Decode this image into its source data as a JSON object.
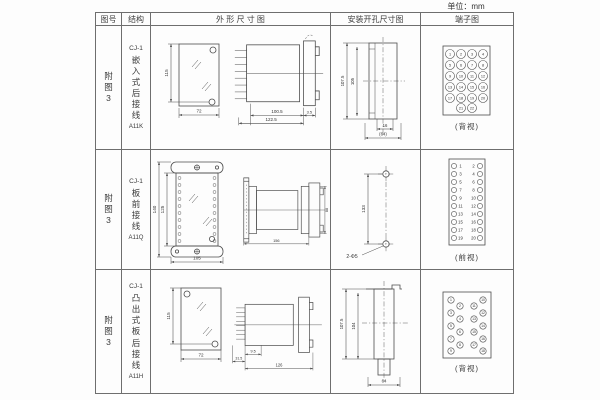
{
  "unit": "单位：mm",
  "header": {
    "fig": "图号",
    "structure": "结构",
    "outline": "外 形 尺 寸 图",
    "mounting": "安装开孔尺寸图",
    "terminal": "端子图"
  },
  "rows": [
    {
      "fig": "附图3",
      "model": "CJ-1",
      "struct": "嵌入式后接线",
      "code": "A11K",
      "view": "(背视)",
      "fd": [
        {
          "x1": 20,
          "y1": 12,
          "x2": 20,
          "y2": 70,
          "t": "115",
          "r": 1,
          "o": 3
        },
        {
          "x1": 28,
          "y1": 83,
          "x2": 68,
          "y2": 83,
          "t": "72"
        }
      ],
      "sd": [
        {
          "x1": 24,
          "y1": 84,
          "x2": 78,
          "y2": 84,
          "t": "100.5"
        },
        {
          "x1": 12,
          "y1": 92,
          "x2": 78,
          "y2": 92,
          "t": "122.5"
        },
        {
          "x1": 78,
          "y1": 84,
          "x2": 90,
          "y2": 84,
          "t": "3.5",
          "fs": 4,
          "o": -2
        }
      ],
      "md": [
        {
          "x1": 12,
          "y1": 12,
          "x2": 12,
          "y2": 88,
          "t": "107.5",
          "r": 1,
          "o": 3,
          "fs": 4.3
        },
        {
          "x1": 22,
          "y1": 16,
          "x2": 22,
          "y2": 85,
          "t": "105",
          "r": 1,
          "o": 3,
          "fs": 4.3
        },
        {
          "x1": 42,
          "y1": 98,
          "x2": 58,
          "y2": 98,
          "t": "16",
          "fs": 4.3,
          "o": -2
        },
        {
          "x1": 30,
          "y1": 107,
          "x2": 66,
          "y2": 107,
          "t": "(64)",
          "fs": 4.3
        }
      ],
      "tc": [
        [
          10,
          10,
          "1"
        ],
        [
          21,
          10,
          "2"
        ],
        [
          32,
          10,
          "3"
        ],
        [
          43,
          10,
          "4"
        ],
        [
          10,
          21,
          "5"
        ],
        [
          21,
          21,
          "6"
        ],
        [
          32,
          21,
          "7"
        ],
        [
          43,
          21,
          "8"
        ],
        [
          10,
          32,
          "9"
        ],
        [
          21,
          32,
          "10"
        ],
        [
          32,
          32,
          "11"
        ],
        [
          43,
          32,
          "12"
        ],
        [
          10,
          43,
          "13"
        ],
        [
          21,
          43,
          "14"
        ],
        [
          32,
          43,
          "15"
        ],
        [
          43,
          43,
          "16"
        ],
        [
          10,
          54,
          "17"
        ],
        [
          21,
          54,
          "18"
        ],
        [
          32,
          54,
          "19"
        ],
        [
          43,
          54,
          "20"
        ],
        [
          21,
          64,
          "21"
        ],
        [
          32,
          64,
          "22"
        ]
      ]
    },
    {
      "fig": "附图3",
      "model": "CJ-1",
      "struct": "板前接线",
      "code": "A11Q",
      "view": "(前视)",
      "fd": [
        {
          "x1": 8,
          "y1": 10,
          "x2": 8,
          "y2": 105,
          "t": "140",
          "r": 1,
          "o": 3
        },
        {
          "x1": 16,
          "y1": 21,
          "x2": 16,
          "y2": 94,
          "t": "125",
          "r": 1,
          "o": 3
        },
        {
          "x1": 20,
          "y1": 110,
          "x2": 72,
          "y2": 110,
          "t": "105"
        }
      ],
      "fstrip": [
        [
          28.5,
          26
        ],
        [
          28.5,
          33
        ],
        [
          28.5,
          40
        ],
        [
          28.5,
          47
        ],
        [
          28.5,
          54
        ],
        [
          28.5,
          61
        ],
        [
          28.5,
          68
        ],
        [
          28.5,
          75
        ],
        [
          28.5,
          82
        ],
        [
          28.5,
          89
        ],
        [
          63.5,
          26
        ],
        [
          63.5,
          33
        ],
        [
          63.5,
          40
        ],
        [
          63.5,
          47
        ],
        [
          63.5,
          54
        ],
        [
          63.5,
          61
        ],
        [
          63.5,
          68
        ],
        [
          63.5,
          75
        ],
        [
          63.5,
          82
        ],
        [
          63.5,
          89
        ]
      ],
      "sd": [
        {
          "x1": 8,
          "y1": 90,
          "x2": 85,
          "y2": 90,
          "t": "156"
        },
        {
          "x1": 104,
          "y1": 22,
          "x2": 104,
          "y2": 78,
          "t": "88",
          "r": 1,
          "o": -3.4
        }
      ],
      "md": [
        {
          "x1": 30,
          "y1": 22,
          "x2": 30,
          "y2": 92,
          "t": "133",
          "r": 1,
          "o": 3
        }
      ],
      "mt": [
        [
          14,
          106,
          "2-Φ5",
          5
        ]
      ],
      "tc": [
        [
          7,
          9
        ],
        [
          33,
          9
        ],
        [
          7,
          17
        ],
        [
          33,
          17
        ],
        [
          7,
          25
        ],
        [
          33,
          25
        ],
        [
          7,
          33
        ],
        [
          33,
          33
        ],
        [
          7,
          41
        ],
        [
          33,
          41
        ],
        [
          7,
          49
        ],
        [
          33,
          49
        ],
        [
          7,
          57
        ],
        [
          33,
          57
        ],
        [
          7,
          65
        ],
        [
          33,
          65
        ],
        [
          7,
          73
        ],
        [
          33,
          73
        ],
        [
          7,
          81
        ],
        [
          33,
          81
        ]
      ],
      "tt": [
        [
          13.5,
          10.6,
          "1"
        ],
        [
          26.5,
          10.6,
          "2"
        ],
        [
          13.5,
          18.6,
          "3"
        ],
        [
          26.5,
          18.6,
          "4"
        ],
        [
          13.5,
          26.6,
          "5"
        ],
        [
          26.5,
          26.6,
          "6"
        ],
        [
          13.5,
          34.6,
          "7"
        ],
        [
          26.5,
          34.6,
          "8"
        ],
        [
          13.5,
          42.6,
          "9"
        ],
        [
          26.5,
          42.6,
          "10"
        ],
        [
          13.5,
          50.6,
          "11"
        ],
        [
          26.5,
          50.6,
          "12"
        ],
        [
          13.5,
          58.6,
          "13"
        ],
        [
          26.5,
          58.6,
          "14"
        ],
        [
          13.5,
          66.6,
          "15"
        ],
        [
          26.5,
          66.6,
          "16"
        ],
        [
          13.5,
          74.6,
          "17"
        ],
        [
          26.5,
          74.6,
          "18"
        ],
        [
          13.5,
          82.6,
          "19"
        ],
        [
          26.5,
          82.6,
          "20"
        ]
      ]
    },
    {
      "fig": "附图3",
      "model": "CJ-1",
      "struct": "凸出式板后接线",
      "code": "A11H",
      "view": "(背视)",
      "fd": [
        {
          "x1": 20,
          "y1": 12,
          "x2": 20,
          "y2": 68,
          "t": "115",
          "r": 1,
          "o": 3
        },
        {
          "x1": 28,
          "y1": 83,
          "x2": 68,
          "y2": 83,
          "t": "72"
        }
      ],
      "sd": [
        {
          "x1": 18,
          "y1": 80,
          "x2": 36,
          "y2": 80,
          "t": "9.5",
          "fs": 4.2,
          "o": -2
        },
        {
          "x1": 4,
          "y1": 88,
          "x2": 18,
          "y2": 88,
          "t": "31.5",
          "fs": 4,
          "o": -2
        },
        {
          "x1": 18,
          "y1": 96,
          "x2": 94,
          "y2": 96,
          "t": "126"
        }
      ],
      "md": [
        {
          "x1": 10,
          "y1": 16,
          "x2": 10,
          "y2": 86,
          "t": "107.5",
          "r": 1,
          "o": 3,
          "fs": 4.3
        },
        {
          "x1": 22,
          "y1": 20,
          "x2": 22,
          "y2": 86,
          "t": "104",
          "r": 1,
          "o": 3,
          "fs": 4.3
        },
        {
          "x1": 32,
          "y1": 112,
          "x2": 64,
          "y2": 112,
          "t": "64",
          "fs": 4.3
        }
      ],
      "tc": [
        [
          12,
          10,
          "1"
        ],
        [
          21,
          16,
          "2"
        ],
        [
          12,
          23,
          "3"
        ],
        [
          21,
          29,
          "4"
        ],
        [
          12,
          36,
          "5"
        ],
        [
          21,
          42,
          "6"
        ],
        [
          12,
          49,
          "7"
        ],
        [
          21,
          55,
          "8"
        ],
        [
          12,
          61,
          "9"
        ],
        [
          44,
          10,
          "10"
        ],
        [
          35,
          16,
          "11"
        ],
        [
          44,
          23,
          "12"
        ],
        [
          35,
          29,
          "13"
        ],
        [
          44,
          36,
          "14"
        ],
        [
          35,
          42,
          "15"
        ],
        [
          44,
          49,
          "16"
        ],
        [
          35,
          55,
          "17"
        ],
        [
          44,
          61,
          "18"
        ]
      ]
    }
  ]
}
